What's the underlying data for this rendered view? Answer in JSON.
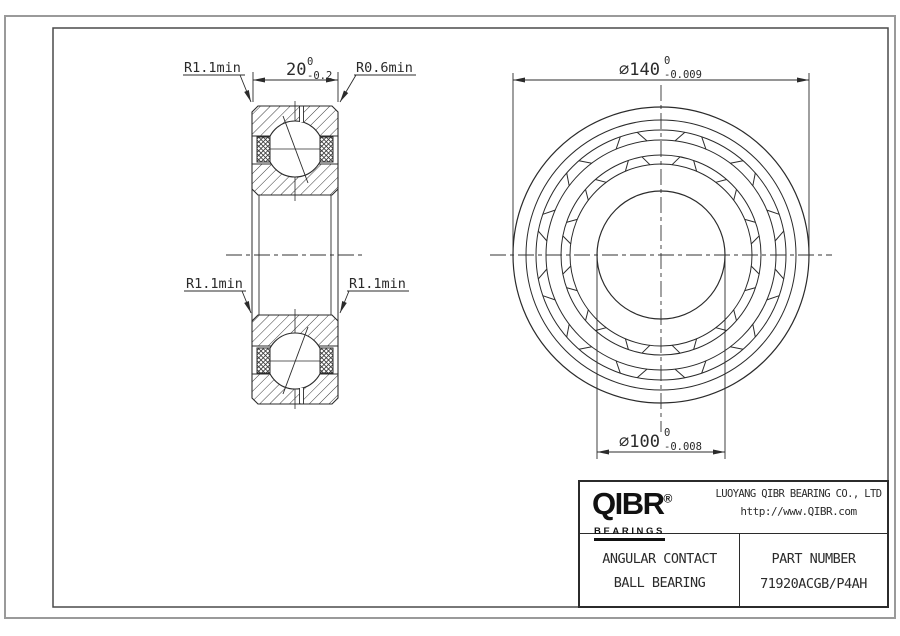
{
  "left_view": {
    "dim_width": {
      "nominal": "20",
      "upper": "0",
      "lower": "-0.2"
    },
    "label_top_left": "R1.1min",
    "label_top_right": "R0.6min",
    "label_bottom_left": "R1.1min",
    "label_bottom_right": "R1.1min"
  },
  "front_view": {
    "dim_od": {
      "nominal": "∅140",
      "upper": "0",
      "lower": "-0.009"
    },
    "dim_bore": {
      "nominal": "∅100",
      "upper": "0",
      "lower": "-0.008"
    }
  },
  "title_block": {
    "logo": {
      "wordmark": "QIBR",
      "registered": "®",
      "tagline": "BEARINGS"
    },
    "company_name": "LUOYANG QIBR BEARING CO., LTD",
    "company_url": "http://www.QIBR.com",
    "product_line1": "ANGULAR CONTACT",
    "product_line2": "BALL BEARING",
    "part_label": "PART NUMBER",
    "part_number": "71920ACGB/P4AH"
  }
}
